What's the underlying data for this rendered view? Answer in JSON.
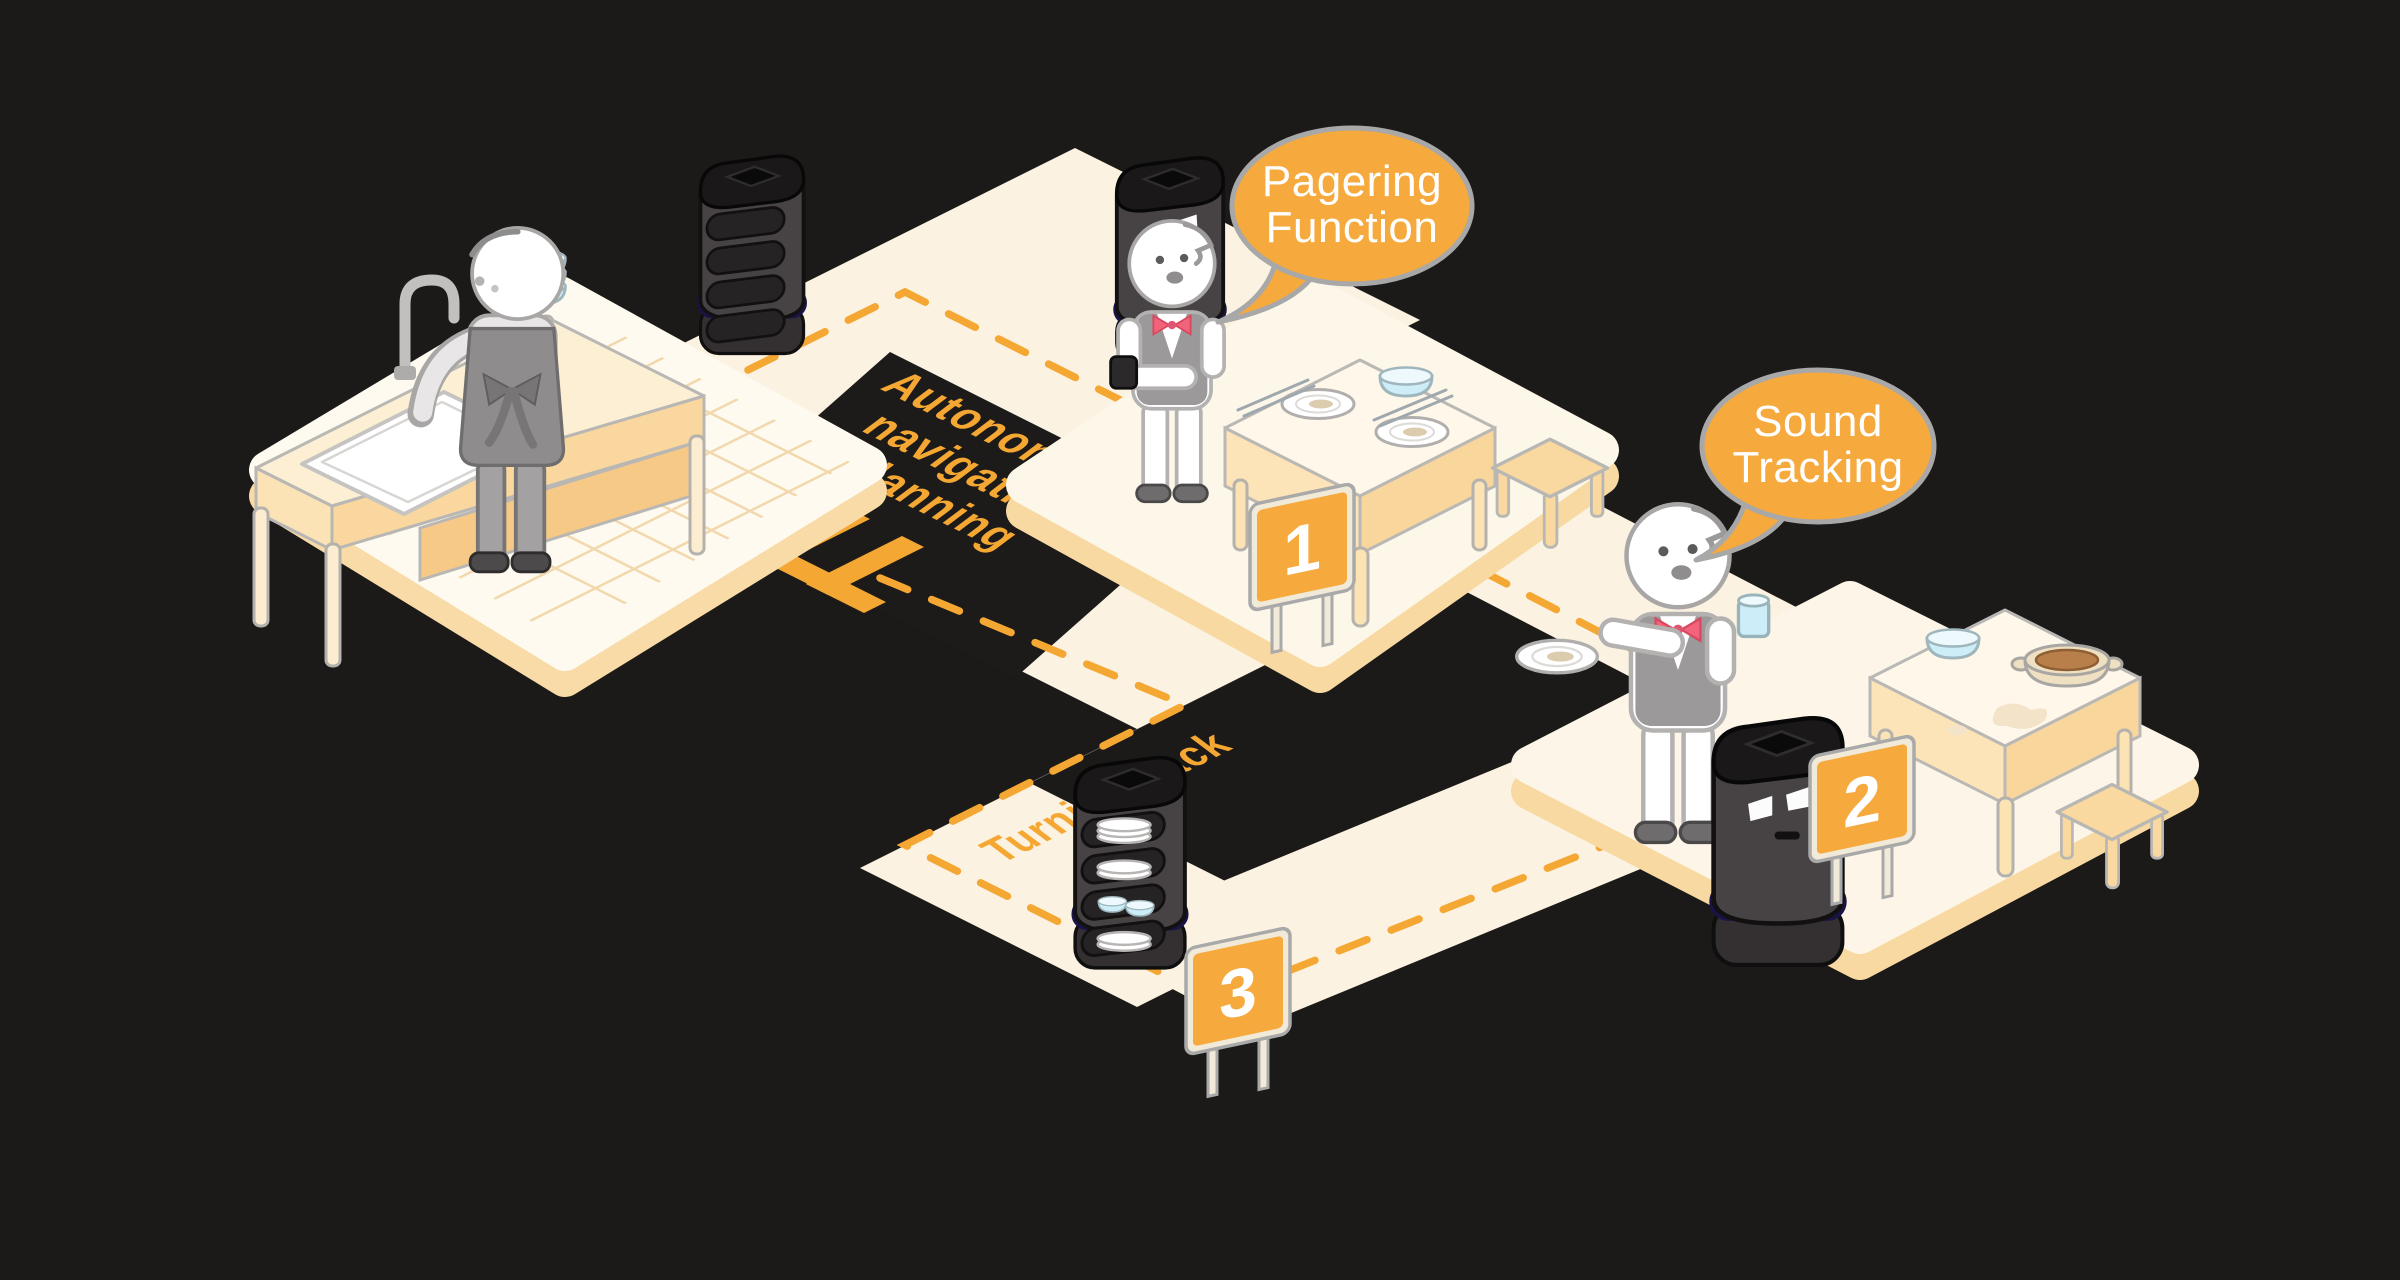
{
  "colors": {
    "background": "#1c1a18",
    "accent_orange": "#f5a733",
    "path_cream": "#fbf2e1",
    "platform_top": "#fefaf0",
    "platform_edge": "#f8d9a2",
    "bubble_fill": "#f6a93d",
    "bubble_border": "#a8a8a8",
    "robot_body": "#474344",
    "robot_band_purple": "#4734c4",
    "bowl_blue": "#cdeef8",
    "bowtie_pink": "#f2647c"
  },
  "speech_bubbles": [
    {
      "id": "pagering",
      "line1": "Pagering",
      "line2": "Function"
    },
    {
      "id": "sound",
      "line1": "Sound",
      "line2": "Tracking"
    }
  ],
  "floor_labels": {
    "autonomous_line1": "Autonomous",
    "autonomous_line2": "navigation",
    "autonomous_line3": "planning",
    "turning_back": "Turning back"
  },
  "signs": [
    {
      "number": "1"
    },
    {
      "number": "2"
    },
    {
      "number": "3"
    }
  ]
}
